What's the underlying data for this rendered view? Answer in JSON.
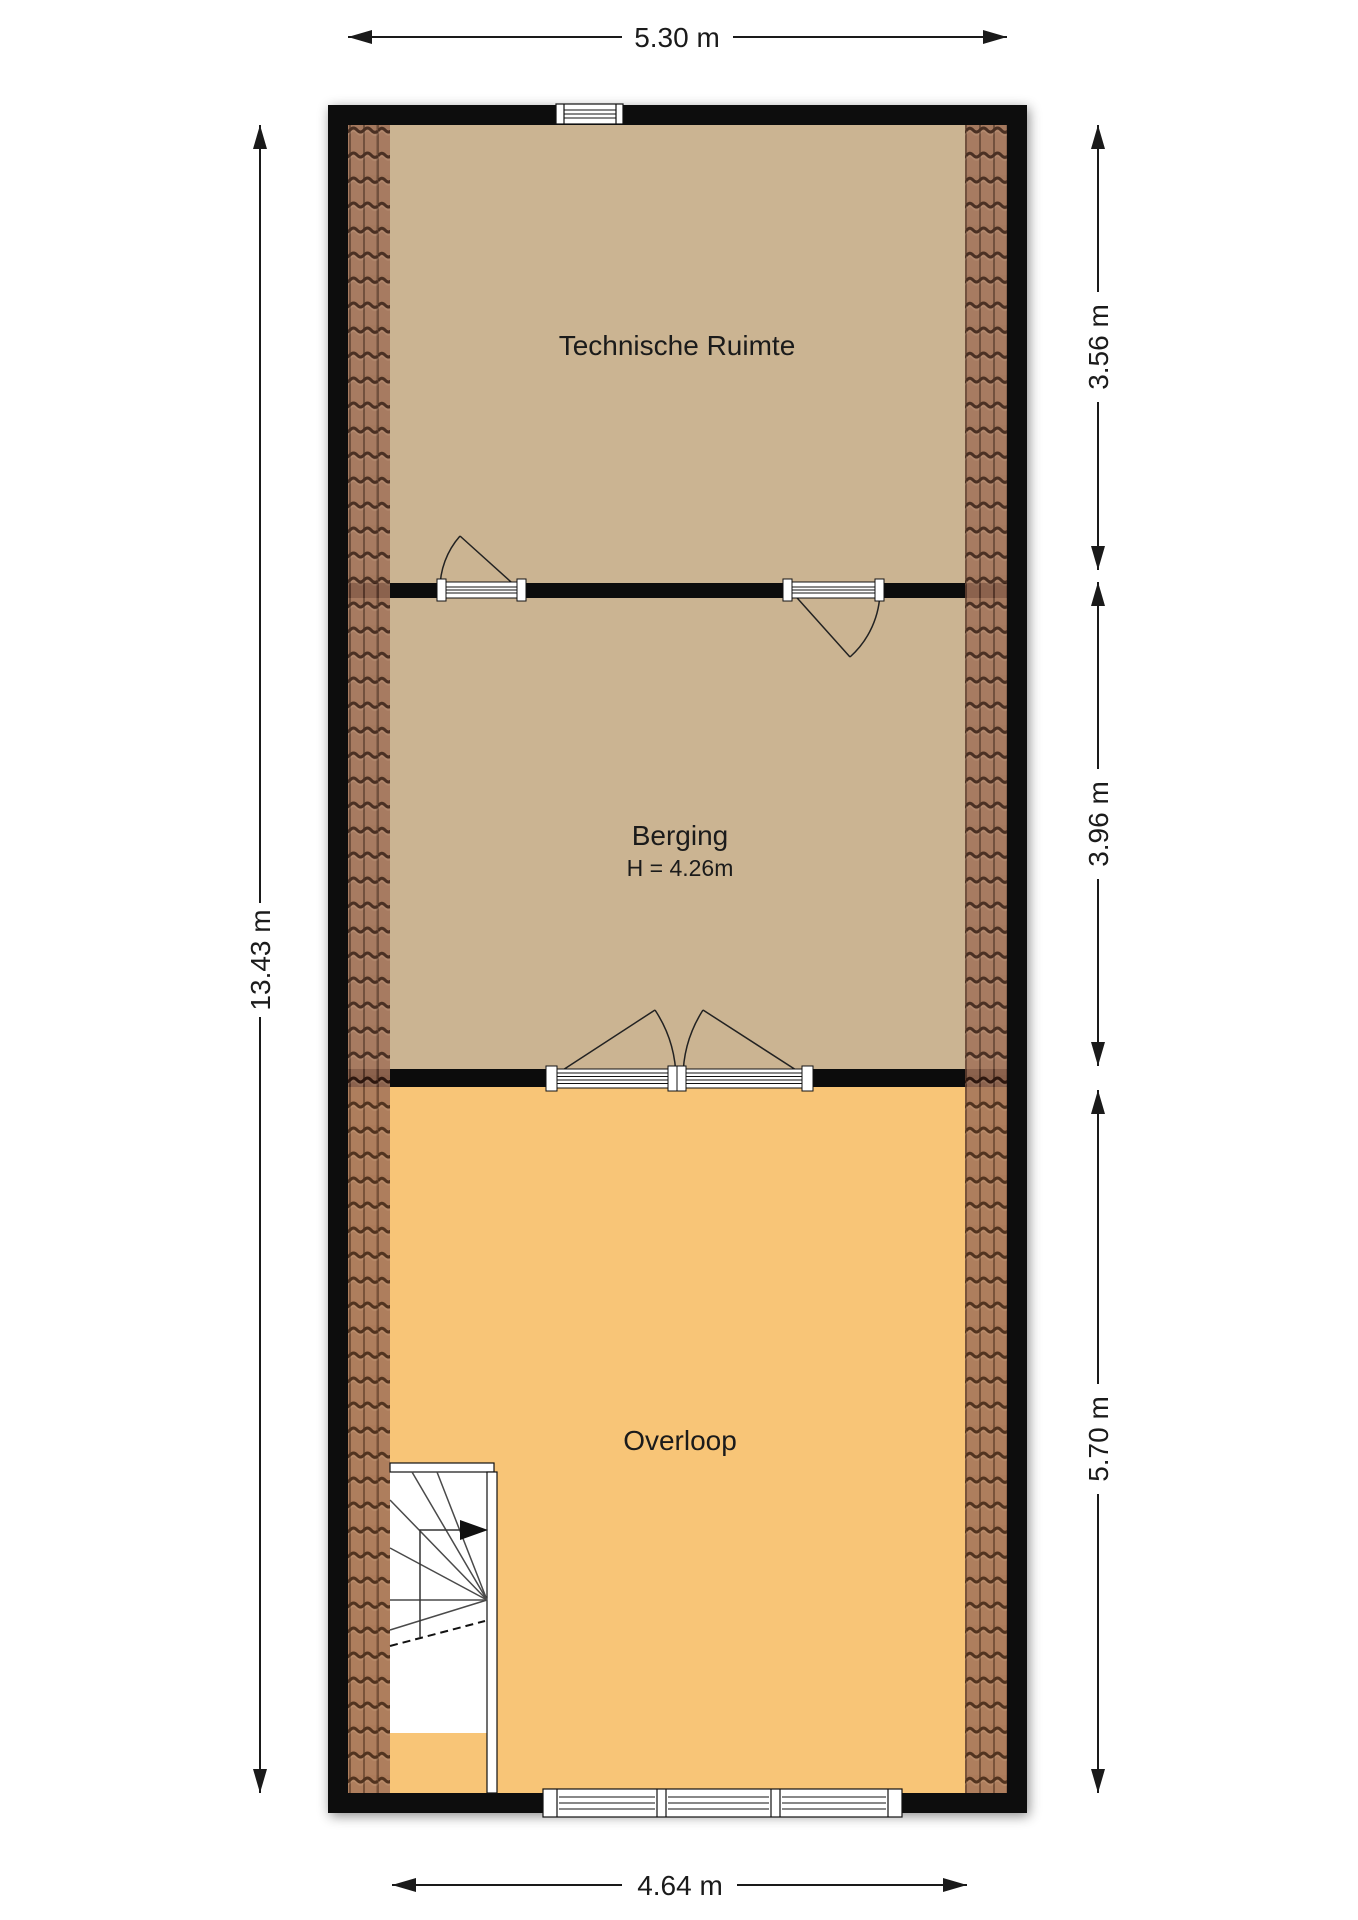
{
  "floorplan": {
    "rooms": [
      {
        "label": "Technische Ruimte"
      },
      {
        "label": "Berging",
        "height_label": "H = 4.26m"
      },
      {
        "label": "Overloop"
      }
    ],
    "dimensions": {
      "top": "5.30 m",
      "left": "13.43 m",
      "right_top": "3.56 m",
      "right_middle": "3.96 m",
      "right_bottom": "5.70 m",
      "bottom": "4.64 m"
    },
    "colors": {
      "wall": "#0c0c0c",
      "floor_tan": "#cbb492",
      "floor_orange": "#f8c577",
      "tile_base": "#9e6e55",
      "tile_line": "#33190f",
      "dimension": "#1a1a1a"
    }
  }
}
